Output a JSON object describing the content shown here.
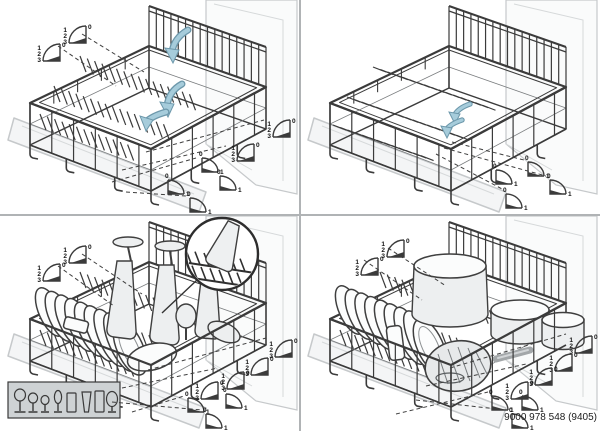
{
  "document": {
    "title": "lower-basket-diagram",
    "part_number": "9000 978 548 (9405)"
  },
  "colors": {
    "background": "#ffffff",
    "divider": "#b0b3b5",
    "wire": "#3b3b3b",
    "light_outline": "#c6c9cb",
    "dish_fill": "#edeff0",
    "arrow_fill": "#a6ccdb",
    "arrow_outline": "#6d98ab",
    "text": "#1c1c1c"
  },
  "fan_labels": {
    "quad": [
      "0",
      "1",
      "2",
      "3"
    ],
    "duo": [
      "0",
      "1"
    ]
  },
  "legend": {
    "glassware": [
      "wine-glass-large",
      "wine-glass-medium",
      "wine-glass-small",
      "champagne-flute",
      "tumbler",
      "pilsner-glass",
      "highball-glass",
      "goblet"
    ]
  },
  "panels": [
    {
      "name": "fold-down-tines",
      "tines": "up",
      "fold_arrow_count": 3,
      "fans": [
        {
          "type": "quad",
          "x": 34,
          "y": 36
        },
        {
          "type": "quad",
          "x": 60,
          "y": 18
        },
        {
          "type": "quad",
          "x": 264,
          "y": 112
        },
        {
          "type": "quad",
          "x": 228,
          "y": 136
        },
        {
          "type": "duo",
          "x": 196,
          "y": 150
        },
        {
          "type": "duo",
          "x": 214,
          "y": 168
        },
        {
          "type": "duo",
          "x": 162,
          "y": 172
        },
        {
          "type": "duo",
          "x": 184,
          "y": 190
        }
      ]
    },
    {
      "name": "tines-folded-flat",
      "tines": "flat",
      "fold_arrow_count": 2,
      "fans": [
        {
          "type": "duo",
          "x": 190,
          "y": 162
        },
        {
          "type": "duo",
          "x": 222,
          "y": 154
        },
        {
          "type": "duo",
          "x": 244,
          "y": 172
        },
        {
          "type": "duo",
          "x": 200,
          "y": 186
        }
      ]
    },
    {
      "name": "loading-plates-and-glasses",
      "tines": "up",
      "fold_arrow_count": 0,
      "fans": [
        {
          "type": "quad",
          "x": 34,
          "y": 40
        },
        {
          "type": "quad",
          "x": 60,
          "y": 22
        },
        {
          "type": "quad",
          "x": 266,
          "y": 116
        },
        {
          "type": "quad",
          "x": 242,
          "y": 134
        },
        {
          "type": "quad",
          "x": 218,
          "y": 148
        },
        {
          "type": "quad",
          "x": 192,
          "y": 158
        },
        {
          "type": "duo",
          "x": 182,
          "y": 174
        },
        {
          "type": "duo",
          "x": 220,
          "y": 170
        },
        {
          "type": "duo",
          "x": 200,
          "y": 190
        }
      ]
    },
    {
      "name": "loading-pots-and-bowls",
      "tines": "up",
      "fold_arrow_count": 0,
      "fans": [
        {
          "type": "quad",
          "x": 52,
          "y": 34
        },
        {
          "type": "quad",
          "x": 78,
          "y": 16
        },
        {
          "type": "quad",
          "x": 266,
          "y": 112
        },
        {
          "type": "quad",
          "x": 246,
          "y": 130
        },
        {
          "type": "quad",
          "x": 226,
          "y": 144
        },
        {
          "type": "quad",
          "x": 202,
          "y": 158
        },
        {
          "type": "duo",
          "x": 186,
          "y": 172
        },
        {
          "type": "duo",
          "x": 216,
          "y": 172
        },
        {
          "type": "duo",
          "x": 206,
          "y": 190
        }
      ]
    }
  ]
}
